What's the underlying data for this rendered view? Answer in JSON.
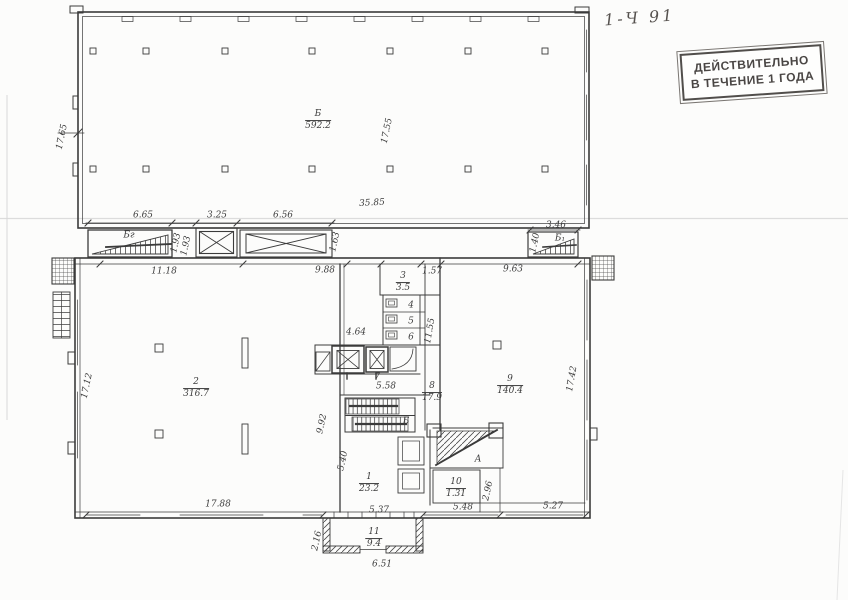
{
  "page": {
    "handwritten_note": "1-Ч 91"
  },
  "stamp": {
    "line1": "ДЕЙСТВИТЕЛЬНО",
    "line2": "В ТЕЧЕНИЕ 1 ГОДА"
  },
  "colors": {
    "ink": "#3b3b3b",
    "paper": "#fcfcfb",
    "stamp_ink": "#4a4644",
    "fold_line": "#dcdcdc"
  },
  "plan_labels": [
    {
      "name": "room-b-upper",
      "text": "Б",
      "den": "592.2",
      "x": 318,
      "y": 121
    },
    {
      "name": "dim-17-55",
      "text": "17.55",
      "x": 388,
      "y": 131,
      "rot": -78
    },
    {
      "name": "dim-17-65",
      "text": "17.65",
      "x": 63,
      "y": 137,
      "rot": -78
    },
    {
      "name": "dim-6-65",
      "text": "6.65",
      "x": 143,
      "y": 216
    },
    {
      "name": "dim-3-25",
      "text": "3.25",
      "x": 217,
      "y": 216
    },
    {
      "name": "dim-6-56",
      "text": "6.56",
      "x": 283,
      "y": 216
    },
    {
      "name": "dim-35-85",
      "text": "35.85",
      "x": 372,
      "y": 204,
      "rot": -3
    },
    {
      "name": "ramp-label-bg",
      "text": "Бг",
      "x": 129,
      "y": 236
    },
    {
      "name": "ramp-label-b1",
      "text": "Б₁",
      "x": 560,
      "y": 239
    },
    {
      "name": "dim-3-46",
      "text": "3.46",
      "x": 556,
      "y": 226
    },
    {
      "name": "dim-1-40",
      "text": "1.40",
      "x": 536,
      "y": 243,
      "rot": -78
    },
    {
      "name": "dim-1-93-a",
      "text": "1.93",
      "x": 177,
      "y": 243,
      "rot": -78
    },
    {
      "name": "dim-1-93-b",
      "text": "1.93",
      "x": 187,
      "y": 246,
      "rot": -78
    },
    {
      "name": "dim-1-63",
      "text": "1.63",
      "x": 336,
      "y": 242,
      "rot": -78
    },
    {
      "name": "dim-11-18",
      "text": "11.18",
      "x": 164,
      "y": 272
    },
    {
      "name": "dim-9-88",
      "text": "9.88",
      "x": 325,
      "y": 271
    },
    {
      "name": "dim-1-57",
      "text": "1.57",
      "x": 432,
      "y": 272
    },
    {
      "name": "dim-9-63",
      "text": "9.63",
      "x": 513,
      "y": 270
    },
    {
      "name": "room-3",
      "text": "3",
      "den": "3.5",
      "x": 403,
      "y": 283
    },
    {
      "name": "room-4",
      "text": "4",
      "x": 411,
      "y": 306
    },
    {
      "name": "room-5",
      "text": "5",
      "x": 411,
      "y": 322
    },
    {
      "name": "room-6",
      "text": "6",
      "x": 411,
      "y": 338
    },
    {
      "name": "dim-4-64",
      "text": "4.64",
      "x": 356,
      "y": 333
    },
    {
      "name": "room-7",
      "text": "7",
      "x": 377,
      "y": 378
    },
    {
      "name": "dim-5-58",
      "text": "5.58",
      "x": 386,
      "y": 387
    },
    {
      "name": "dim-11-55",
      "text": "11.55",
      "x": 431,
      "y": 331,
      "rot": -80
    },
    {
      "name": "room-8",
      "text": "8",
      "den": "17.9",
      "x": 432,
      "y": 393
    },
    {
      "name": "stair-label-b",
      "text": "Б",
      "x": 406,
      "y": 422
    },
    {
      "name": "room-1",
      "text": "1",
      "den": "23.2",
      "x": 369,
      "y": 484
    },
    {
      "name": "stair-label-a",
      "text": "А",
      "x": 478,
      "y": 460
    },
    {
      "name": "room-10",
      "text": "10",
      "den": "1.31",
      "x": 456,
      "y": 489
    },
    {
      "name": "dim-9-92",
      "text": "9.92",
      "x": 323,
      "y": 424,
      "rot": -78
    },
    {
      "name": "dim-5-40",
      "text": "5.40",
      "x": 344,
      "y": 461,
      "rot": -78
    },
    {
      "name": "room-2",
      "text": "2",
      "den": "316.7",
      "x": 196,
      "y": 389
    },
    {
      "name": "room-9",
      "text": "9",
      "den": "140.4",
      "x": 510,
      "y": 386
    },
    {
      "name": "dim-17-42",
      "text": "17.42",
      "x": 573,
      "y": 379,
      "rot": -80
    },
    {
      "name": "dim-17-12",
      "text": "17.12",
      "x": 88,
      "y": 386,
      "rot": -78
    },
    {
      "name": "dim-17-88",
      "text": "17.88",
      "x": 218,
      "y": 505
    },
    {
      "name": "dim-5-37",
      "text": "5.37",
      "x": 379,
      "y": 511
    },
    {
      "name": "dim-5-48",
      "text": "5.48",
      "x": 463,
      "y": 508
    },
    {
      "name": "dim-2-96",
      "text": "2.96",
      "x": 489,
      "y": 491,
      "rot": -78
    },
    {
      "name": "dim-5-27",
      "text": "5.27",
      "x": 553,
      "y": 507
    },
    {
      "name": "room-11",
      "text": "11",
      "den": "9.4",
      "x": 374,
      "y": 539
    },
    {
      "name": "dim-6-51",
      "text": "6.51",
      "x": 382,
      "y": 565
    },
    {
      "name": "dim-2-16",
      "text": "2.16",
      "x": 318,
      "y": 541,
      "rot": -78
    }
  ]
}
